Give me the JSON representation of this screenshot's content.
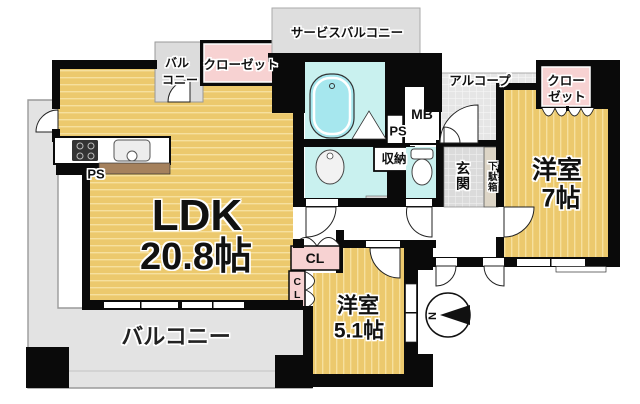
{
  "rooms": {
    "ldk": {
      "name": "LDK",
      "size": "20.8帖"
    },
    "western7": {
      "name": "洋室",
      "size": "7帖"
    },
    "western51": {
      "name": "洋室",
      "size": "5.1帖"
    }
  },
  "areas": {
    "balcony": "バルコニー",
    "service_balcony": "サービスバルコニー",
    "small_balcony_line1": "バル",
    "small_balcony_line2": "コニー",
    "alcove": "アルコープ",
    "entrance": "玄関",
    "shoe_cabinet": "下駄箱",
    "storage": "収納",
    "closet_ldk": "クローゼット",
    "closet7_line1": "クロー",
    "closet7_line2": "ゼット",
    "closet_cl_1": "CL",
    "closet_cl_2": "CL",
    "pipe_space_kitchen": "PS",
    "pipe_space_hall": "PS",
    "meter_box": "MB"
  },
  "compass": {
    "north": "N"
  },
  "colors": {
    "room_floor_tan": "#ecc96d",
    "floor_stripe": "#f6e09e",
    "closet_pink": "#f7d2d2",
    "wet_area_cyan": "#c9f1ef",
    "bathtub_cyan": "#a6e7ee",
    "balcony_gray": "#e3e3e3",
    "counter_brown": "#a5815d",
    "wall": "#0a0a0a"
  }
}
